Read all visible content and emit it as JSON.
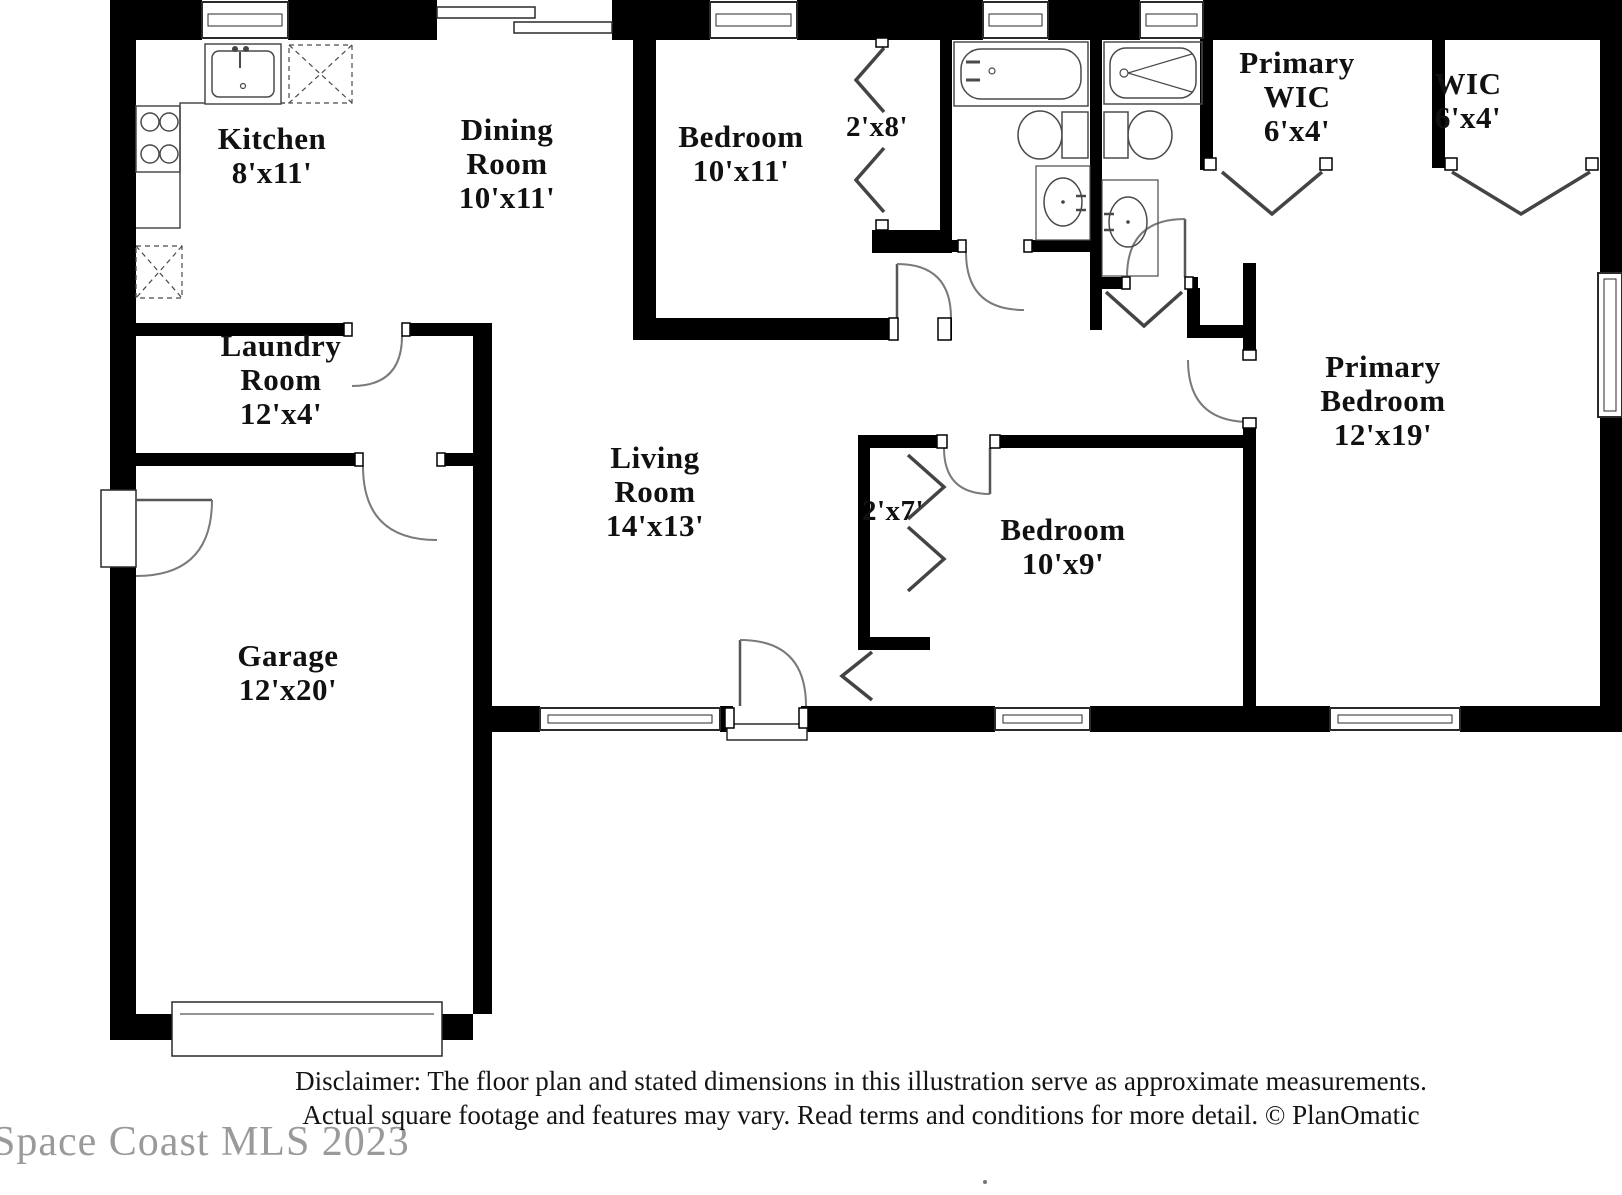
{
  "rooms": {
    "kitchen": {
      "name": "Kitchen",
      "dims": "8'x11'"
    },
    "dining_room": {
      "name": "Dining Room",
      "dims": "10'x11'"
    },
    "bedroom_2": {
      "name": "Bedroom",
      "dims": "10'x11'"
    },
    "bedroom_2_closet": {
      "dims": "2'x8'"
    },
    "primary_wic": {
      "name": "Primary WIC",
      "dims": "6'x4'"
    },
    "wic": {
      "name": "WIC",
      "dims": "6'x4'"
    },
    "laundry_room": {
      "name": "Laundry Room",
      "dims": "12'x4'"
    },
    "living_room": {
      "name": "Living Room",
      "dims": "14'x13'"
    },
    "hall_closet": {
      "dims": "2'x7'"
    },
    "bedroom_3": {
      "name": "Bedroom",
      "dims": "10'x9'"
    },
    "primary_bedroom": {
      "name": "Primary Bedroom",
      "dims": "12'x19'"
    },
    "garage": {
      "name": "Garage",
      "dims": "12'x20'"
    }
  },
  "footer": {
    "disclaimer_line1": "Disclaimer: The floor plan and stated dimensions in this illustration serve as approximate measurements.",
    "disclaimer_line2": "Actual square footage and features may vary. Read terms and conditions for more detail. © PlanOmatic",
    "watermark": "Space Coast MLS 2023"
  },
  "colors": {
    "wall": "#000000",
    "fixture_line": "#4a4a4a",
    "door_arc": "#7a7a7a",
    "label_text": "#111111",
    "watermark_text": "#9a9a9a"
  }
}
